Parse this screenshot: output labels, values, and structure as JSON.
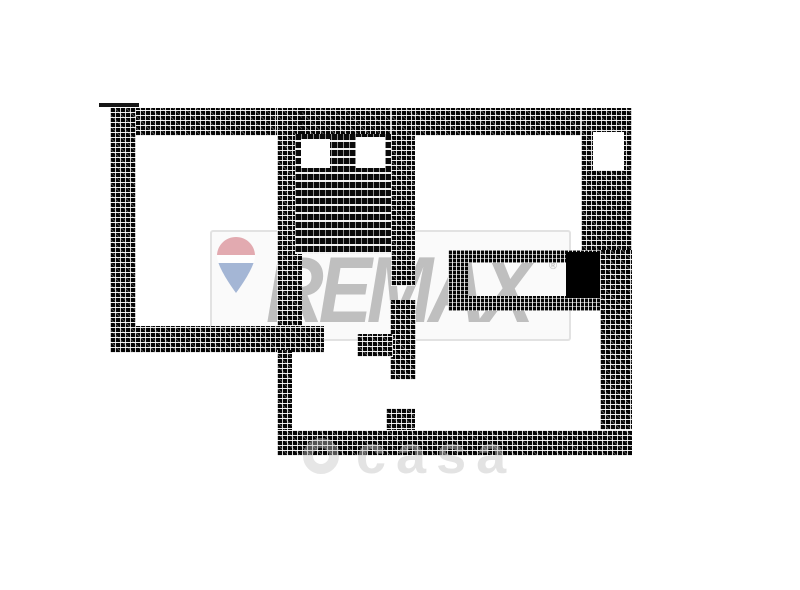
{
  "watermark": {
    "brand_text": "REMAX",
    "registered_mark": "®",
    "brand_color": "#bfbfbf",
    "balloon_red": "#dd979e",
    "balloon_white": "#ffffff",
    "balloon_blue": "#8fa6cd",
    "footer_symbol": "©",
    "footer_text": "casa",
    "footer_color": "#c4c4c4"
  },
  "plan": {
    "wall_color": "#000000",
    "background_color": "#ffffff"
  }
}
